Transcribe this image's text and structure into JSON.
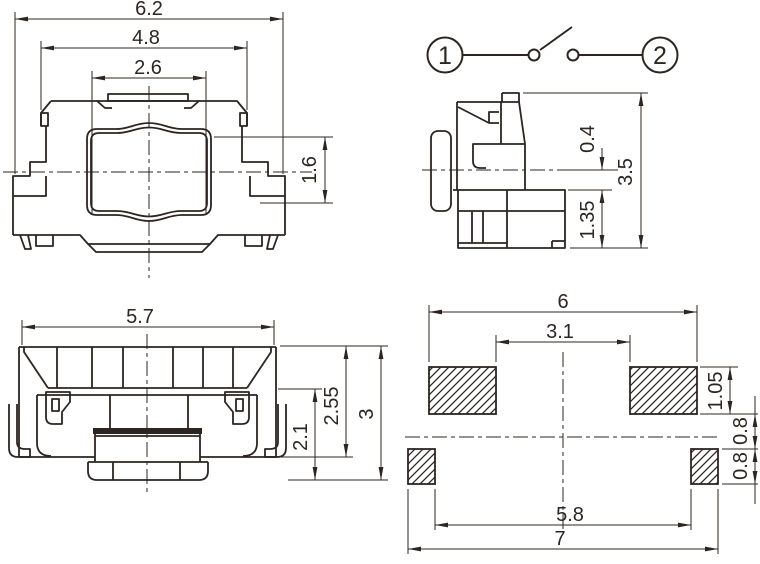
{
  "drawing": {
    "front_view": {
      "dim_overall_width": "6.2",
      "dim_cover_width": "4.8",
      "dim_plate_width": "2.6",
      "dim_button_height": "1.6"
    },
    "circuit_diagram": {
      "terminal_left": "1",
      "terminal_right": "2"
    },
    "side_view": {
      "dim_center_to_base": "0.4",
      "dim_overall_height": "3.5",
      "dim_base_height": "1.35"
    },
    "rear_view": {
      "dim_body_width": "5.7",
      "dim_inner_height": "2.1",
      "dim_mid_height": "2.55",
      "dim_overall_height": "3"
    },
    "pcb_layout": {
      "dim_pad_outer_span": "6",
      "dim_pad_inner_span": "3.1",
      "dim_pad_height": "1.05",
      "dim_upper_gap": "0.8",
      "dim_lower_gap": "0.8",
      "dim_small_pad_inner_span": "5.8",
      "dim_overall_span": "7"
    },
    "colors": {
      "line": "#2d2522",
      "background": "#ffffff"
    }
  }
}
